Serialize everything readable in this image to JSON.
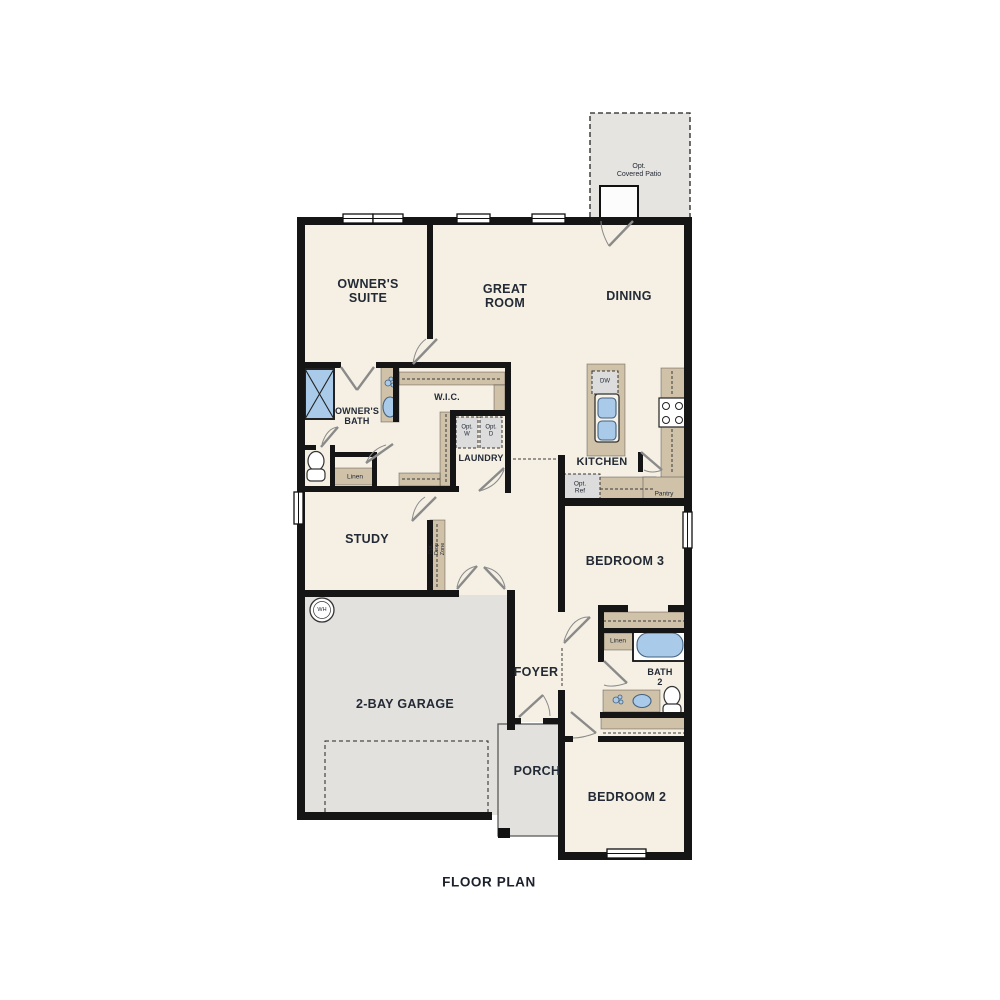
{
  "title": "FLOOR PLAN",
  "rooms": {
    "owners_suite": "OWNER'S\nSUITE",
    "great_room": "GREAT\nROOM",
    "dining": "DINING",
    "owners_bath": "OWNER'S\nBATH",
    "wic": "W.I.C.",
    "laundry": "LAUNDRY",
    "kitchen": "KITCHEN",
    "study": "STUDY",
    "bedroom3": "BEDROOM 3",
    "foyer": "FOYER",
    "bath2": "BATH\n2",
    "garage": "2-BAY GARAGE",
    "porch": "PORCH",
    "bedroom2": "BEDROOM 2"
  },
  "features": {
    "opt_covered_patio": "Opt.\nCovered Patio",
    "linen_owners": "Linen",
    "linen_hall": "Linen",
    "pantry": "Pantry",
    "opt_washer": "Opt.\nW",
    "opt_dryer": "Opt.\nD",
    "opt_ref": "Opt.\nRef",
    "dishwasher": "DW",
    "water_heater": "WH",
    "opt_drop_zone": "Opt.\nDrop\nZone"
  },
  "colors": {
    "wall": "#151515",
    "room_fill": "#f5f0e3",
    "garage_fill": "#e3e1de",
    "patio_fill": "#e6e4e1",
    "cabinet_fill": "#cfc2a9",
    "optional_fill": "#dcdcdc",
    "fixture_blue": "#a9cbe9",
    "fixture_edge": "#44617e",
    "door_line": "#8a8a8a",
    "text": "#232a36"
  }
}
